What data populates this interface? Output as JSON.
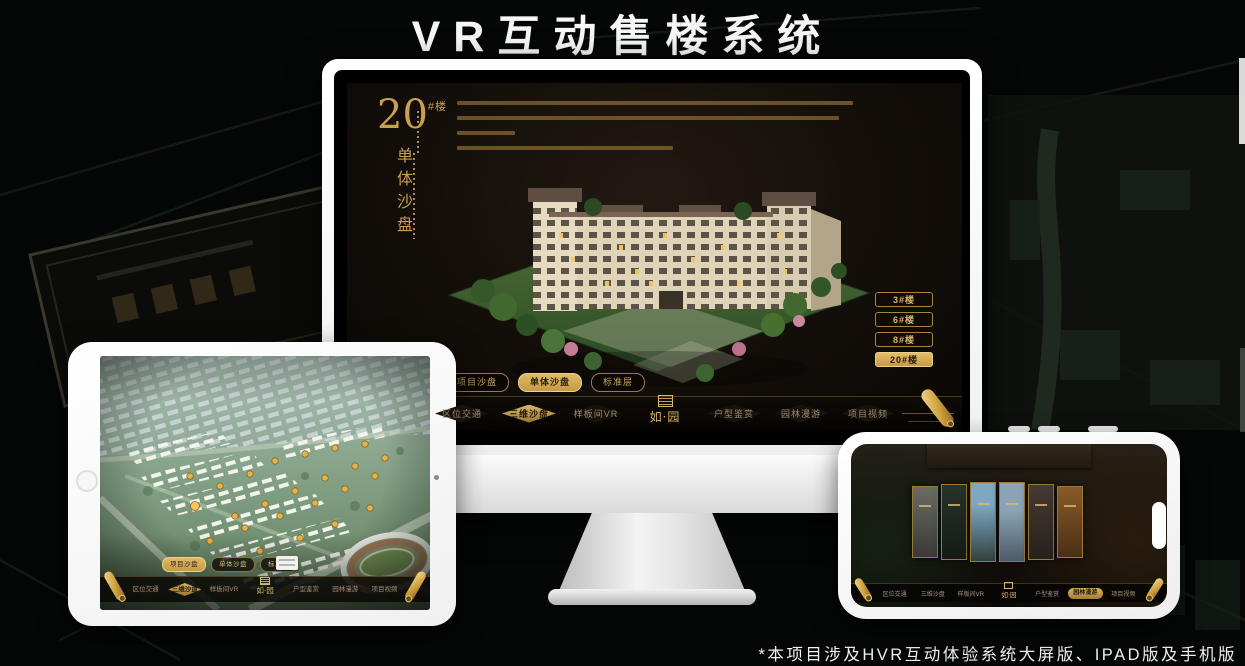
{
  "page": {
    "title": "VR互动售楼系统",
    "footnote": "*本项目涉及HVR互动体验系统大屏版、IPAD版及手机版"
  },
  "colors": {
    "accent_gold": "#c9a45c",
    "active_gold_fill": "#d9b469",
    "screen_background": "#16100a",
    "title_white": "#f7f7f7"
  },
  "icons": {
    "scroll_icon": "rolled-gold-scroll",
    "seal_icon": "square-seal-stamp",
    "home_button_icon": "circle",
    "camera_icon": "dot",
    "notch": "capsule"
  },
  "monitor": {
    "headline": {
      "number": "20",
      "unit": "#楼",
      "subtitle": "单体沙盘"
    },
    "floor_buttons": [
      {
        "label": "3#楼",
        "active": false
      },
      {
        "label": "6#楼",
        "active": false
      },
      {
        "label": "8#楼",
        "active": false
      },
      {
        "label": "20#楼",
        "active": true
      }
    ],
    "mode_tabs": [
      {
        "label": "项目沙盘",
        "active": false
      },
      {
        "label": "单体沙盘",
        "active": true
      },
      {
        "label": "标准层",
        "active": false
      }
    ],
    "nav": {
      "logo": "如·园",
      "items": [
        {
          "label": "区位交通",
          "active": false
        },
        {
          "label": "三维沙盘",
          "active": true
        },
        {
          "label": "样板间VR",
          "active": false
        },
        {
          "label": "户型鉴赏",
          "active": false
        },
        {
          "label": "园林漫游",
          "active": false
        },
        {
          "label": "项目视频",
          "active": false
        }
      ]
    }
  },
  "tablet": {
    "mode_tabs": [
      {
        "label": "项目沙盘",
        "active": true
      },
      {
        "label": "单体沙盘",
        "active": false
      },
      {
        "label": "标准层",
        "active": false
      }
    ],
    "nav": {
      "logo": "如·园",
      "items": [
        {
          "label": "区位交通",
          "active": false
        },
        {
          "label": "三维沙盘",
          "active": true
        },
        {
          "label": "样板间VR",
          "active": false
        },
        {
          "label": "户型鉴赏",
          "active": false
        },
        {
          "label": "园林漫游",
          "active": false
        },
        {
          "label": "项目视频",
          "active": false
        }
      ]
    }
  },
  "phone": {
    "nav": {
      "logo": "如·园",
      "items": [
        {
          "label": "区位交通",
          "active": false
        },
        {
          "label": "三维沙盘",
          "active": false
        },
        {
          "label": "样板间VR",
          "active": false
        },
        {
          "label": "户型鉴赏",
          "active": false
        },
        {
          "label": "园林漫游",
          "active": true
        },
        {
          "label": "项目视频",
          "active": false
        }
      ]
    }
  }
}
